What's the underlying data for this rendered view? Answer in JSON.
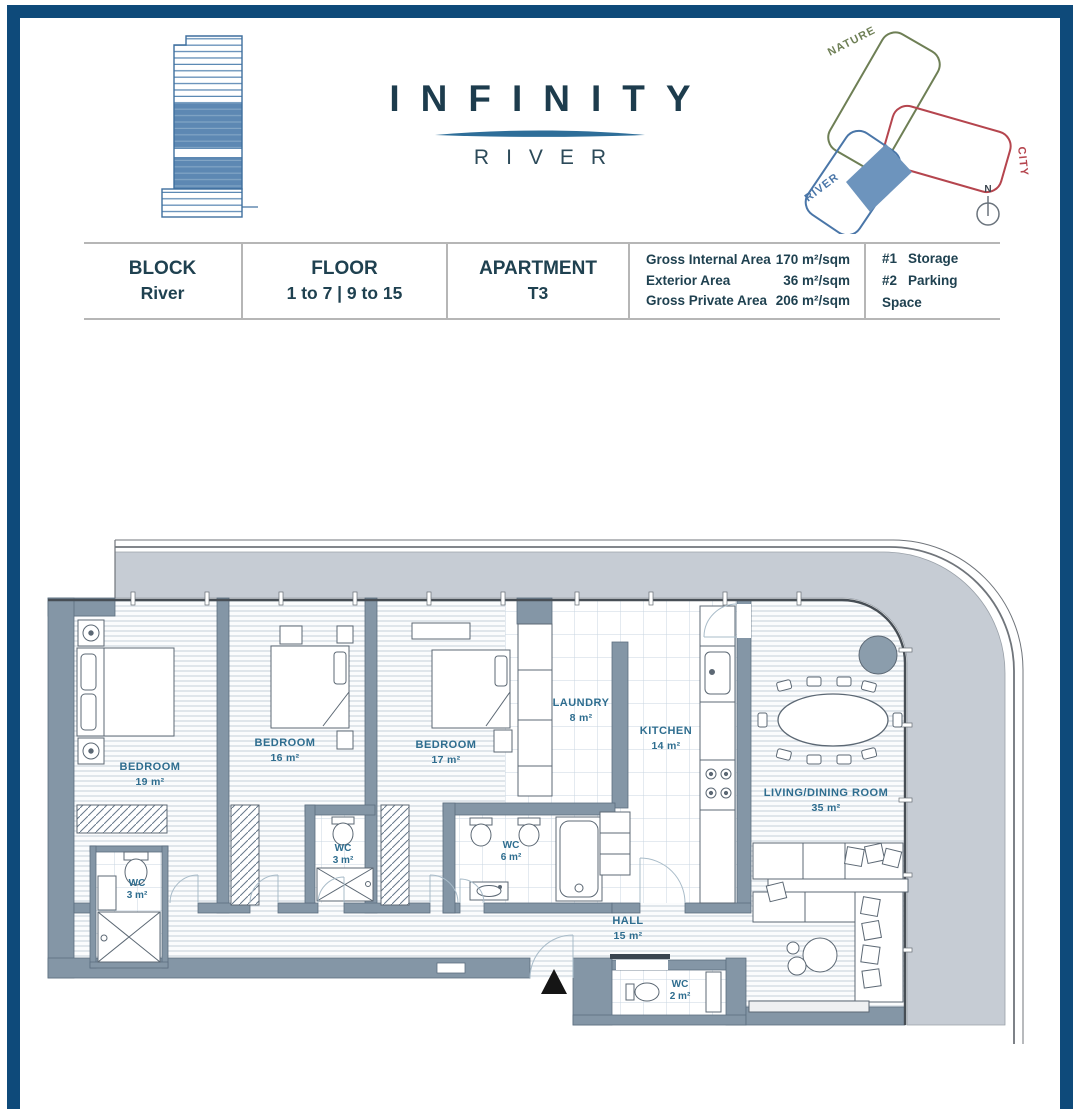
{
  "header": {
    "logo_title": "INFINITY",
    "logo_subtitle": "RIVER",
    "site_diagram": {
      "labels": {
        "nature": "NATURE",
        "city": "CITY",
        "river": "RIVER"
      },
      "compass": "N",
      "colors": {
        "nature": "#6e7f55",
        "city": "#b5454e",
        "river": "#4a76a8",
        "highlight": "#6d94bd"
      }
    },
    "colors": {
      "logo_text": "#1d3c4d",
      "swoosh": "#2e6e99",
      "building_blue": "#5d88b3"
    }
  },
  "info_table": {
    "columns": [
      {
        "label": "BLOCK",
        "value": "River"
      },
      {
        "label": "FLOOR",
        "value": "1 to 7 | 9 to 15"
      },
      {
        "label": "APARTMENT",
        "value": "T3"
      }
    ],
    "areas": [
      {
        "label": "Gross Internal Area",
        "value": "170 m²/sqm"
      },
      {
        "label": "Exterior Area",
        "value": "36 m²/sqm"
      },
      {
        "label": "Gross Private Area",
        "value": "206 m²/sqm"
      }
    ],
    "extras": [
      {
        "num": "#1",
        "label": "Storage"
      },
      {
        "num": "#2",
        "label": "Parking Space"
      }
    ]
  },
  "plan": {
    "rooms": [
      {
        "name": "BEDROOM",
        "area": "19 m²"
      },
      {
        "name": "BEDROOM",
        "area": "16 m²"
      },
      {
        "name": "BEDROOM",
        "area": "17 m²"
      },
      {
        "name": "LAUNDRY",
        "area": "8 m²"
      },
      {
        "name": "KITCHEN",
        "area": "14 m²"
      },
      {
        "name": "LIVING/DINING ROOM",
        "area": "35 m²"
      },
      {
        "name": "WC",
        "area": "3 m²"
      },
      {
        "name": "WC",
        "area": "3 m²"
      },
      {
        "name": "WC",
        "area": "6 m²"
      },
      {
        "name": "WC",
        "area": "2 m²"
      },
      {
        "name": "HALL",
        "area": "15 m²"
      }
    ],
    "colors": {
      "wall": "#8496a6",
      "terrace": "#c6ccd4",
      "label": "#2e6d8f",
      "border": "#0e4a7a"
    }
  }
}
